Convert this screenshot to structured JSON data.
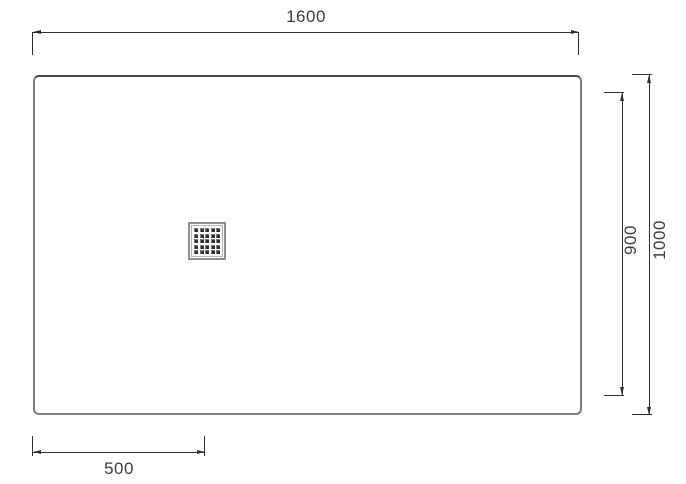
{
  "diagram": {
    "type": "technical-drawing",
    "dimensions": {
      "top_width": {
        "label": "1600"
      },
      "right_outer_height": {
        "label": "1000"
      },
      "right_inner_height": {
        "label": "900"
      },
      "bottom_left_offset": {
        "label": "500"
      }
    },
    "drain": {
      "icon": "drain-grate-icon",
      "grid_rows": 5,
      "grid_cols": 5
    },
    "colors": {
      "line": "#2f2f2f",
      "tray_border": "#7e7e7e",
      "text": "#3d3d3d",
      "background": "#ffffff"
    }
  }
}
